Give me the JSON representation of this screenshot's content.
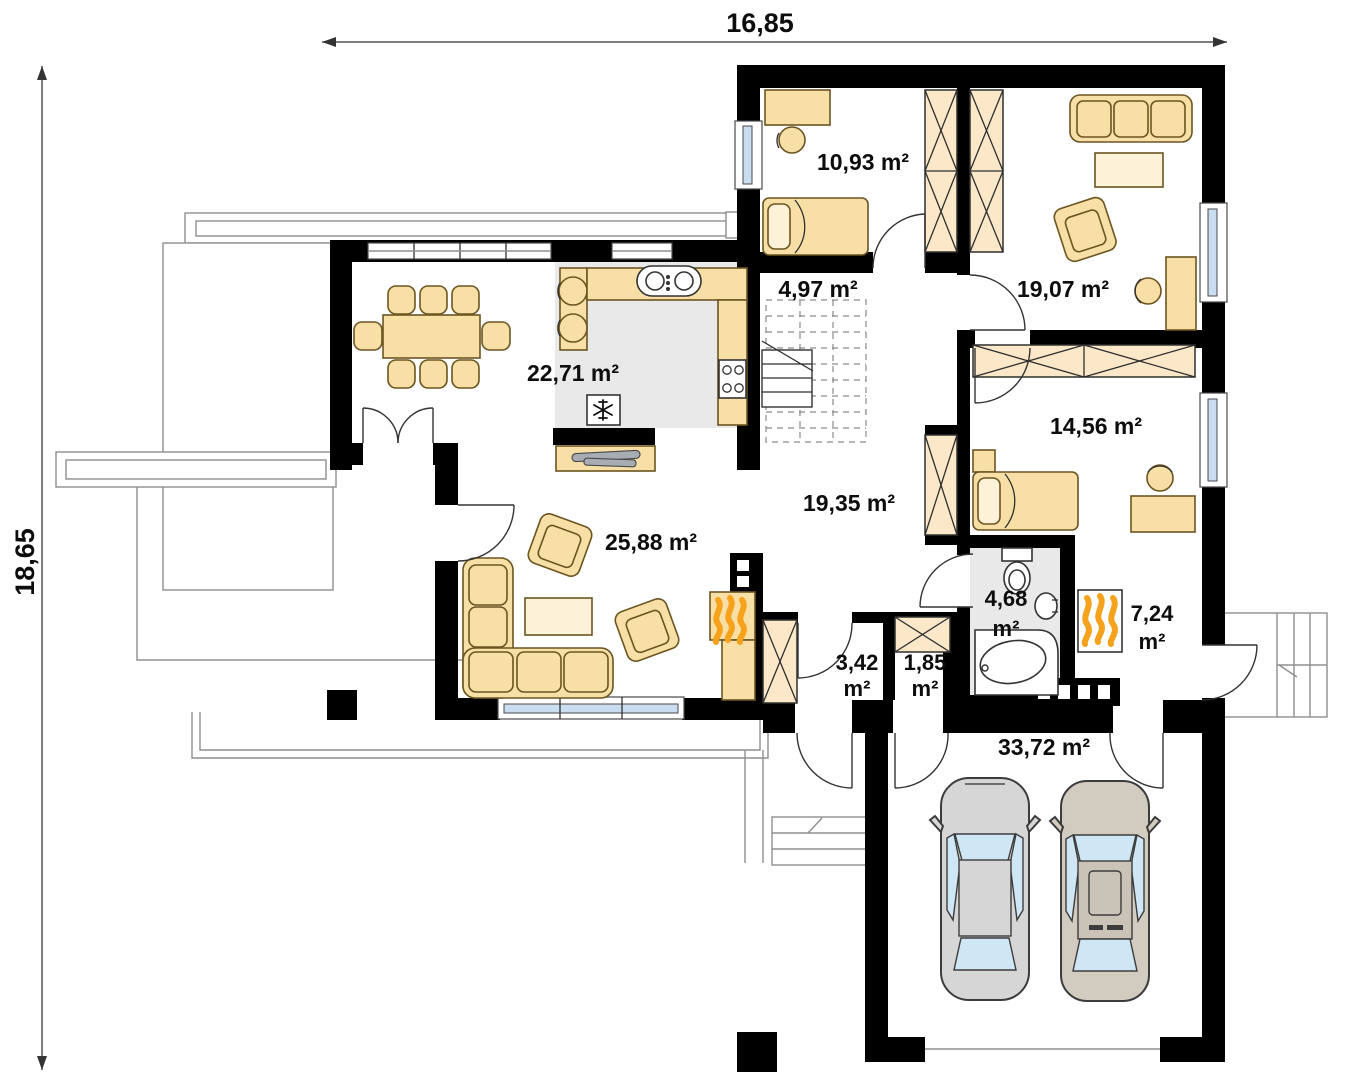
{
  "dimensions": {
    "top": "16,85",
    "left": "18,65"
  },
  "labels": {
    "bedroom_top": "10,93 m²",
    "room_1907": "19,07 m²",
    "stairs": "4,97 m²",
    "kitchen_dining": "22,71 m²",
    "bedroom_right": "14,56 m²",
    "hall": "19,35 m²",
    "living_room": "25,88 m²",
    "garage": "33,72 m²",
    "bathroom": {
      "value": "4,68",
      "unit": "m²"
    },
    "boiler_room": {
      "value": "7,24",
      "unit": "m²"
    },
    "closet_a": {
      "value": "3,42",
      "unit": "m²"
    },
    "closet_b": {
      "value": "1,85",
      "unit": "m²"
    }
  },
  "colors": {
    "wall": "#000000",
    "furniture": "#f8dfa6",
    "furniture_light": "#fdf1d7",
    "wardrobe": "#fbe8c8",
    "window_glass": "#c9dcf0",
    "floor_gray": "#e9e9e9",
    "flame_orange": "#f6a21c",
    "car_gray": "#d6d6d6",
    "car_beige": "#d2ccc0"
  }
}
